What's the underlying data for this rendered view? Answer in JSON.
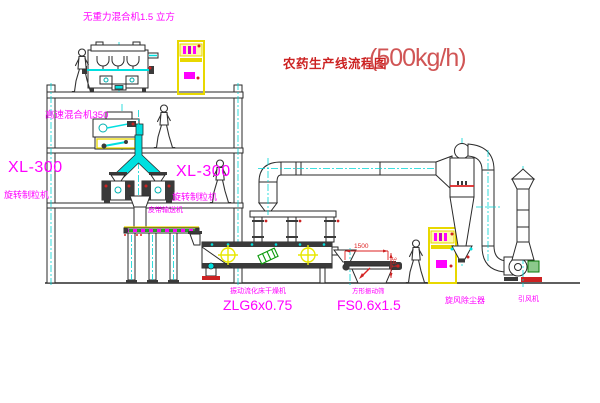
{
  "title": {
    "text": "农药生产线流程图",
    "capacity": "(500kg/h)"
  },
  "labels": {
    "top_mixer": "无重力混合机1.5 立方",
    "highspeed_mixer": "高速混合机350",
    "xl300_left": "XL-300",
    "granulator_left": "旋转制粒机",
    "xl300_right": "XL-300",
    "granulator_right": "旋转制粒机",
    "belt_conveyor": "皮带输送机",
    "dryer_name": "振动流化床干燥机",
    "dryer_model": "ZLG6x0.75",
    "sieve_name": "方形振动筛",
    "sieve_model": "FS0.6x1.5",
    "cyclone": "旋风除尘器",
    "fan": "引风机"
  },
  "dimensions": {
    "sieve_length": "1500",
    "sieve_height": "341"
  },
  "colors": {
    "label_magenta": "#ff00ff",
    "title_red": "#cc2222",
    "dimension_red": "#dd2222",
    "centerline_cyan": "#00d5d5",
    "chute_cyan": "#00e0e0",
    "cabinet_yellow": "#e8d800",
    "motor_green": "#0a7a0a",
    "line_black": "#2a2a2a",
    "background": "#ffffff"
  }
}
